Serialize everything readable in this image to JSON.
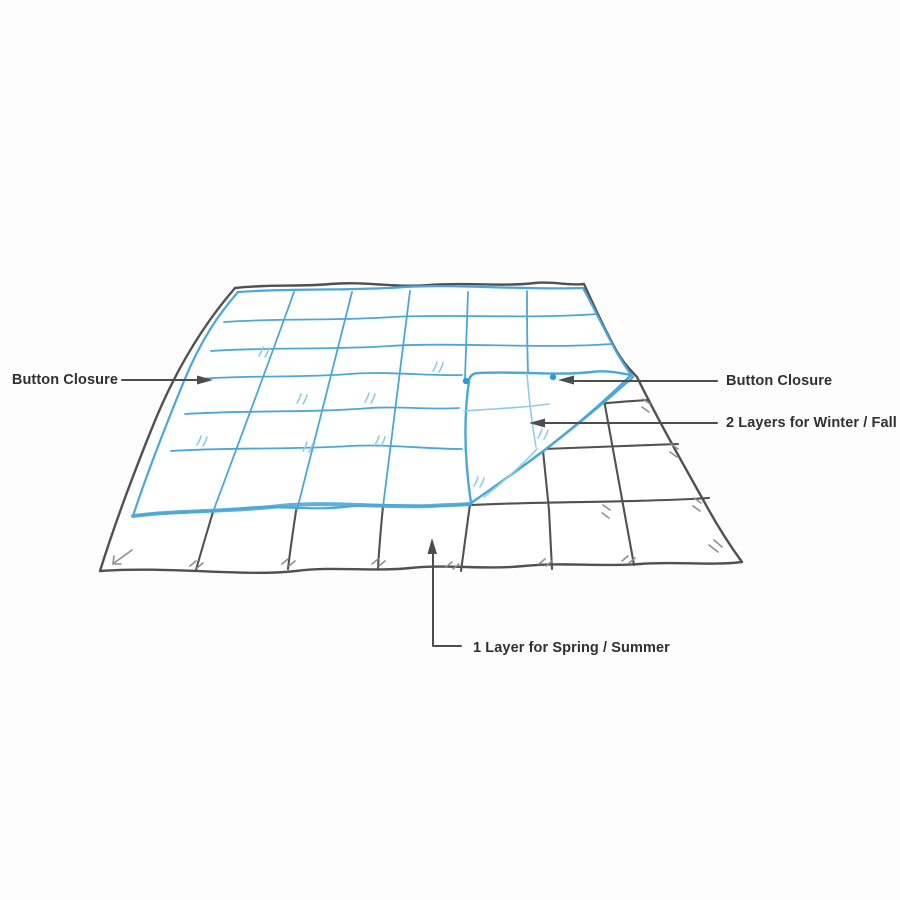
{
  "callouts": {
    "button_closure_left": {
      "label": "Button Closure"
    },
    "button_closure_right": {
      "label": "Button Closure"
    },
    "winter": {
      "label": "2 Layers for Winter / Fall"
    },
    "summer": {
      "label": "1 Layer for Spring / Summer"
    }
  },
  "diagram": {
    "top_layer_button_count": 2
  },
  "colors": {
    "top_layer_blue": "#4ba7d7",
    "flap_light_blue": "#93cbe7",
    "button_blue": "#2d9bd1",
    "bottom_layer_line": "#515151",
    "mark_gray": "#8f8f8f",
    "callout_line": "#4d4d4d",
    "label_text": "#303030",
    "background": "#fdfdfd"
  }
}
